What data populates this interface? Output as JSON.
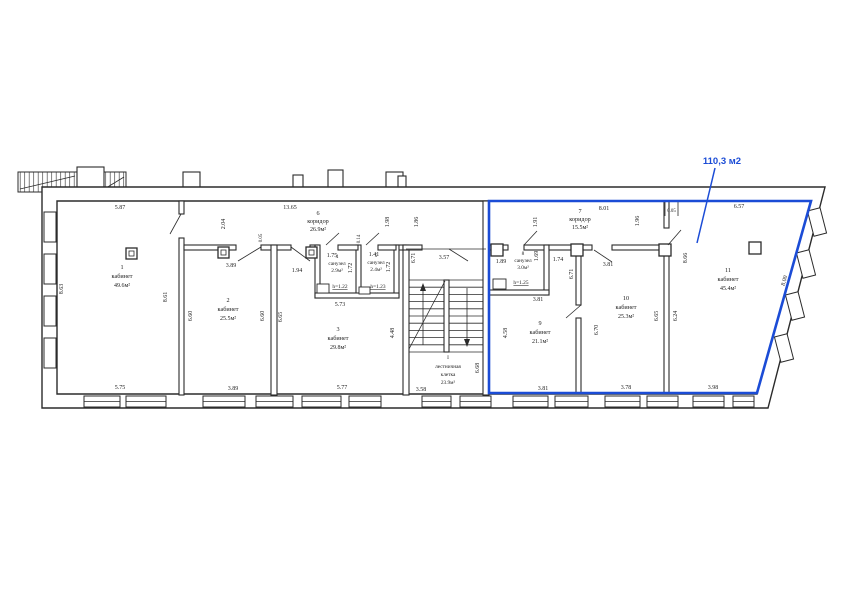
{
  "colors": {
    "highlight": "#1b4cd6",
    "ink": "#2b2b2b"
  },
  "highlight": {
    "label": "110,3 м2"
  },
  "rooms": {
    "r1": {
      "number": "1",
      "name": "кабинет",
      "area": "49.6м²"
    },
    "r2": {
      "number": "2",
      "name": "кабинет",
      "area": "25.5м²"
    },
    "r3": {
      "number": "3",
      "name": "кабинет",
      "area": "29.8м²"
    },
    "r4": {
      "number": "4",
      "name": "санузел",
      "area": "2.9м²",
      "note": "h=1.22"
    },
    "r5": {
      "number": "5",
      "name": "санузел",
      "area": "2.4м²",
      "note": "h=1.23"
    },
    "r6": {
      "number": "6",
      "name": "коридор",
      "area": "26.9м²"
    },
    "r7": {
      "number": "7",
      "name": "коридор",
      "area": "15.5м²"
    },
    "r8": {
      "number": "8",
      "name": "санузел",
      "area": "3.0м²",
      "note": "h=1.25"
    },
    "r9": {
      "number": "9",
      "name": "кабинет",
      "area": "21.1м²"
    },
    "r10": {
      "number": "10",
      "name": "кабинет",
      "area": "25.3м²"
    },
    "r11": {
      "number": "11",
      "name": "кабинет",
      "area": "45.4м²"
    },
    "stairs": {
      "number": "I",
      "name1": "лестничная",
      "name2": "клетка",
      "area": "23.9м²"
    }
  },
  "dims": {
    "r1_top": "5.87",
    "corridor6_top": "13.65",
    "r7_top": "8.01",
    "r11_top": "6.57",
    "r7_wall": "0.05",
    "corridor6_left": "2.04",
    "corridor6_mid1": "1.98",
    "corridor6_mid2": "1.86",
    "r7_left": "1.91",
    "r7_right": "1.96",
    "r1_left": "8.63",
    "r1_right": "8.61",
    "r1_bottom": "5.75",
    "r2_top": "3.89",
    "r2_left": "6.60",
    "r2_right": "6.60",
    "r2_bottom": "3.89",
    "r23_wall": "0.05",
    "r3_top": "1.94",
    "r3_left": "6.65",
    "r3_right": "4.48",
    "r3_mid": "5.73",
    "r3_bottom": "5.77",
    "wc4_top": "1.75",
    "wc4_side": "1.72",
    "wc5_top": "1.41",
    "wc5_side": "1.72",
    "wc45_wall": "0.14",
    "stair_left": "6.71",
    "stair_top": "3.57",
    "stair_right": "6.68",
    "stair_bottom": "3.58",
    "wc8_top": "1.89",
    "wc8_side": "1.69",
    "wc8_bottom": "3.81",
    "wc8_right": "1.74",
    "r9_wall": "6.71",
    "r9_left": "4.58",
    "r9_bottom": "3.81",
    "r10_top": "3.81",
    "r10_left": "6.70",
    "r10_right": "6.65",
    "r11_left_low": "6.24",
    "r10_bottom": "3.78",
    "r11_left": "8.66",
    "r11_slant": "8.00",
    "r11_bottom": "3.98"
  }
}
